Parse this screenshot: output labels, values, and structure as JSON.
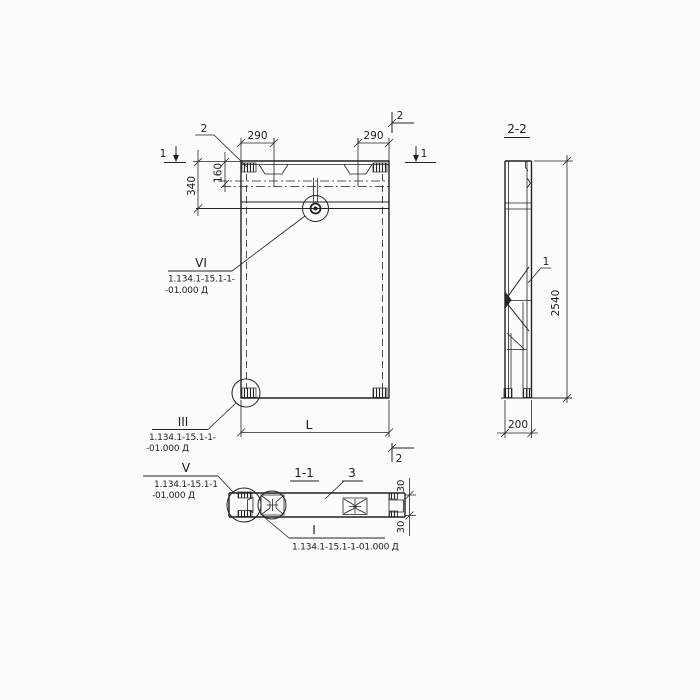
{
  "front_view": {
    "leader_label_top_left": "2",
    "section1_left": "1",
    "section1_right": "1",
    "section2_top": "2",
    "section2_bottom": "2",
    "dim_290_left": "290",
    "dim_290_right": "290",
    "dim_340": "340",
    "dim_160": "160",
    "dim_length": "L"
  },
  "side_view": {
    "title": "2-2",
    "dim_height": "2540",
    "dim_width": "200",
    "part_label": "1"
  },
  "plan_view": {
    "title": "1-1",
    "part_label": "3",
    "dim_30_top": "30",
    "dim_30_bottom": "30"
  },
  "callouts": {
    "vi": {
      "label": "VI",
      "ref1": "1.134.1-15.1-1-",
      "ref2": "-01.000 Д"
    },
    "iii": {
      "label": "III",
      "ref1": "1.134.1-15.1-1-",
      "ref2": "-01.000 Д"
    },
    "v": {
      "label": "V",
      "ref1": "1.134.1-15.1-1",
      "ref2": "-01.000 Д"
    },
    "i": {
      "label": "I",
      "ref": "1.134.1-15.1-1-01.000 Д"
    }
  }
}
